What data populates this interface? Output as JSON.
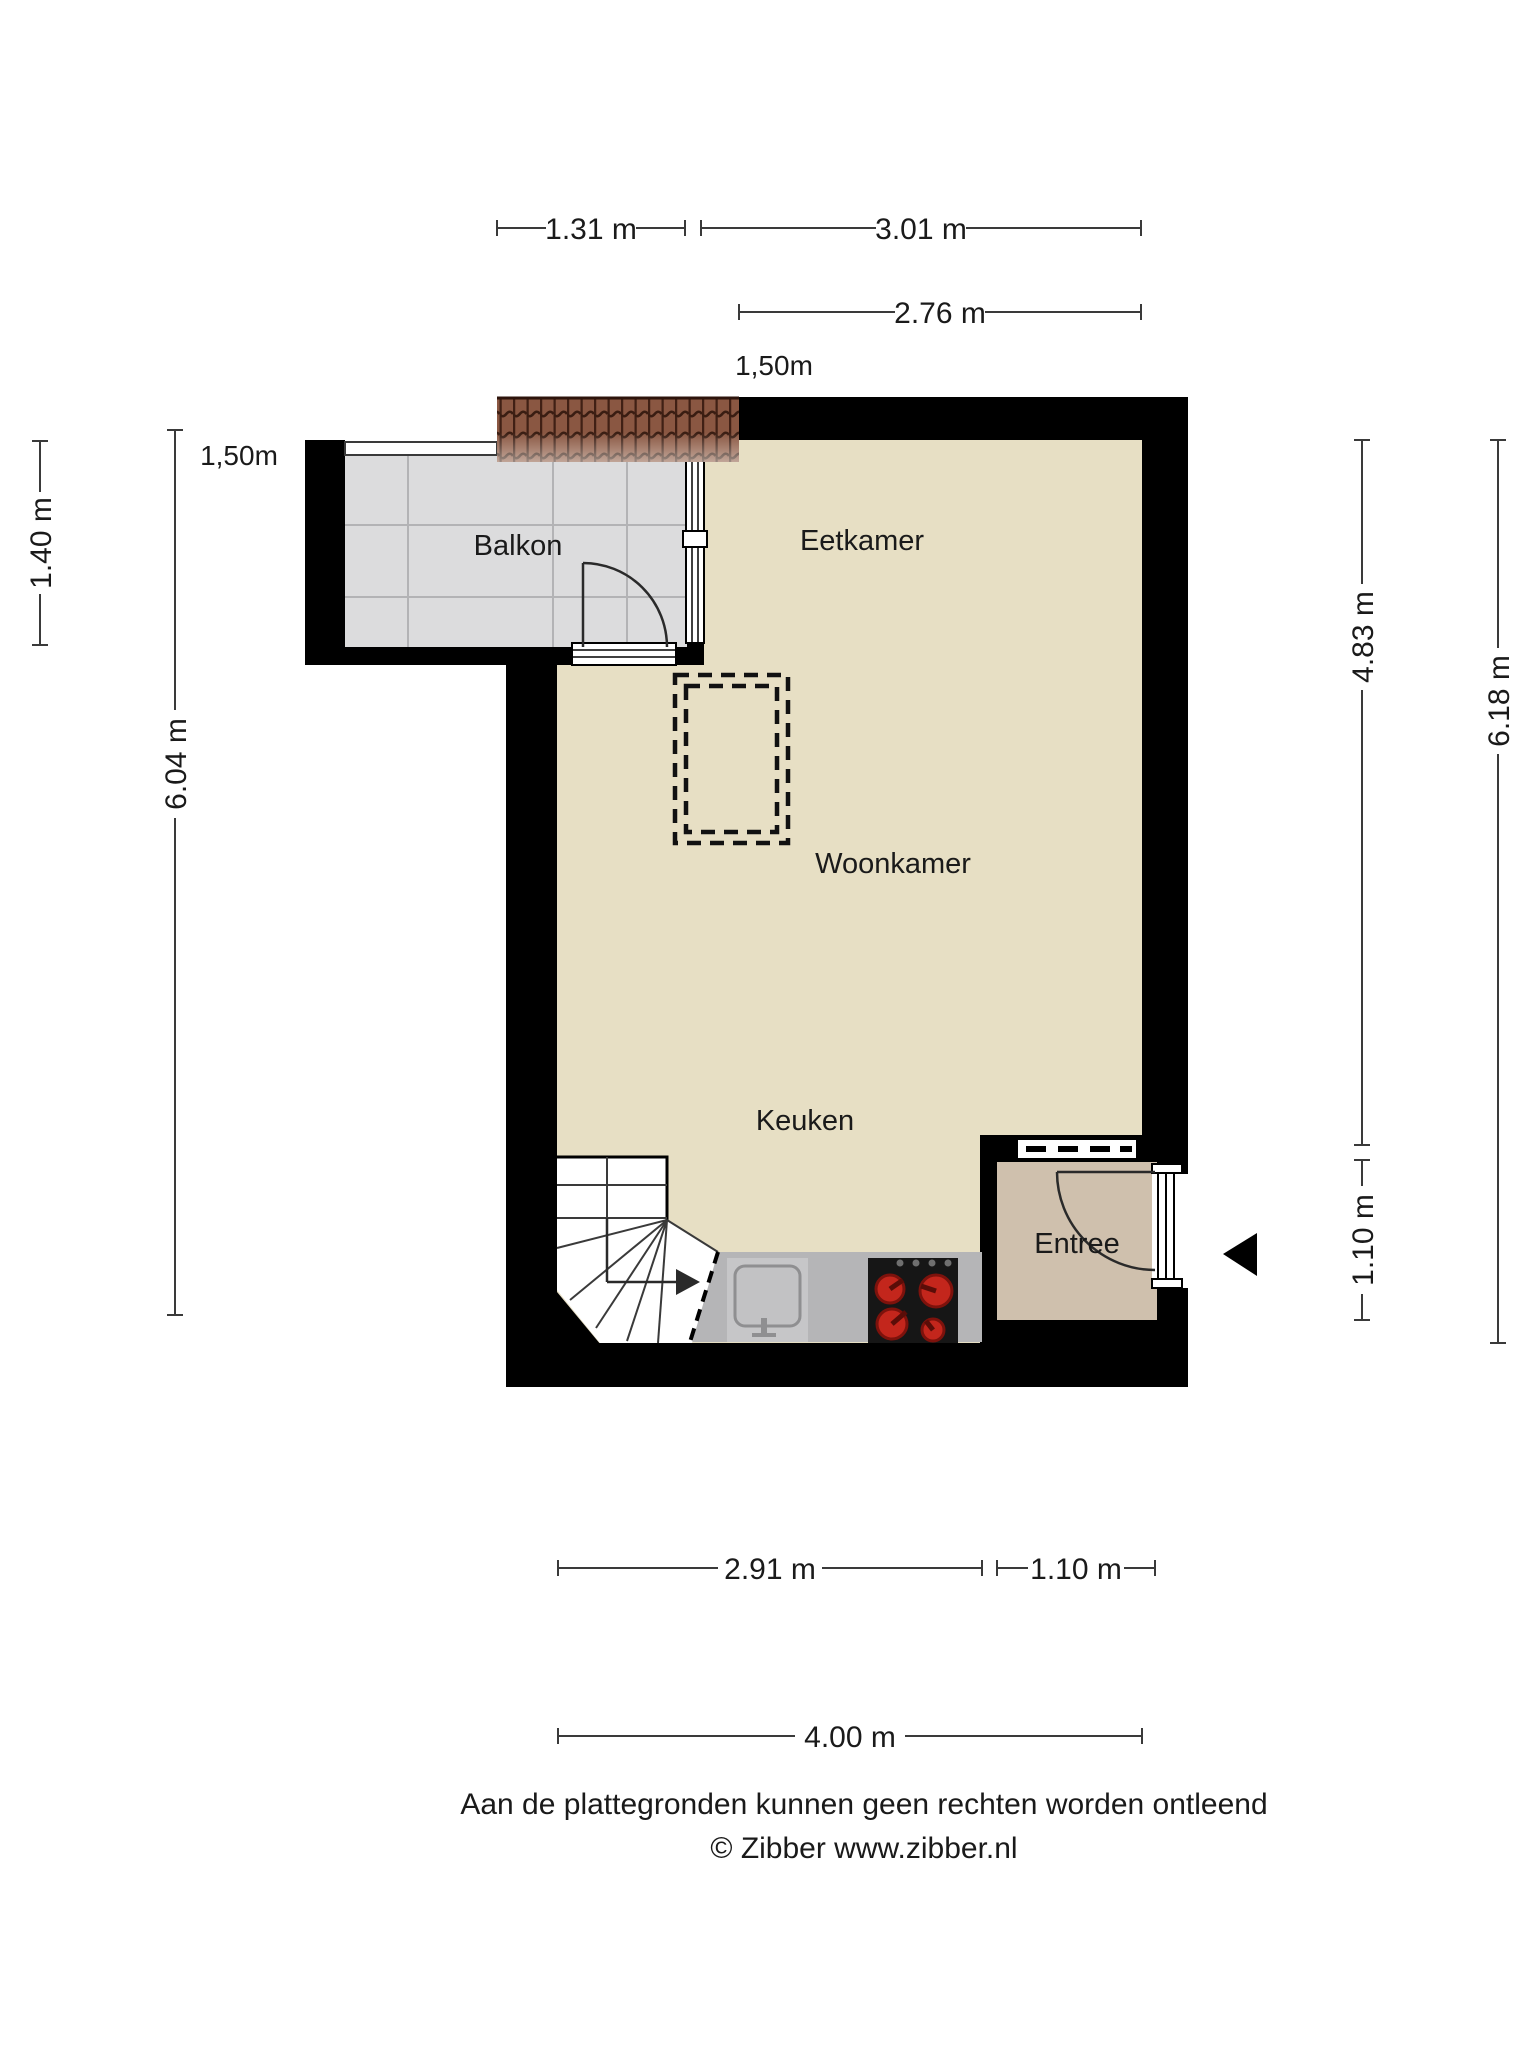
{
  "title": "Floor plan (plattegrond)",
  "rooms": {
    "balkon": "Balkon",
    "eetkamer": "Eetkamer",
    "woonkamer": "Woonkamer",
    "keuken": "Keuken",
    "entree": "Entree"
  },
  "dimensions": {
    "top": {
      "d131": "1.31 m",
      "d301": "3.01 m",
      "d276": "2.76 m",
      "roof": "1,50m"
    },
    "left": {
      "roof": "1,50m",
      "d140": "1.40 m",
      "d604": "6.04 m"
    },
    "right": {
      "d483": "4.83 m",
      "d110": "1.10 m",
      "d618": "6.18 m"
    },
    "bottom": {
      "d291": "2.91 m",
      "d110": "1.10 m",
      "d400": "4.00 m"
    }
  },
  "footer": {
    "disclaimer": "Aan de plattegronden kunnen geen rechten worden ontleend",
    "copyright": "© Zibber www.zibber.nl"
  },
  "colors": {
    "wall": "#000000",
    "floor": "#e7dfc4",
    "entree_floor": "#cfc0ad",
    "balcony_floor": "#dcdcdd",
    "counter": "#b5b5b7",
    "sink_panel": "#c6c6c8",
    "stove": "#161616",
    "burner": "#c3261c",
    "roof_base": "#8a5742"
  }
}
